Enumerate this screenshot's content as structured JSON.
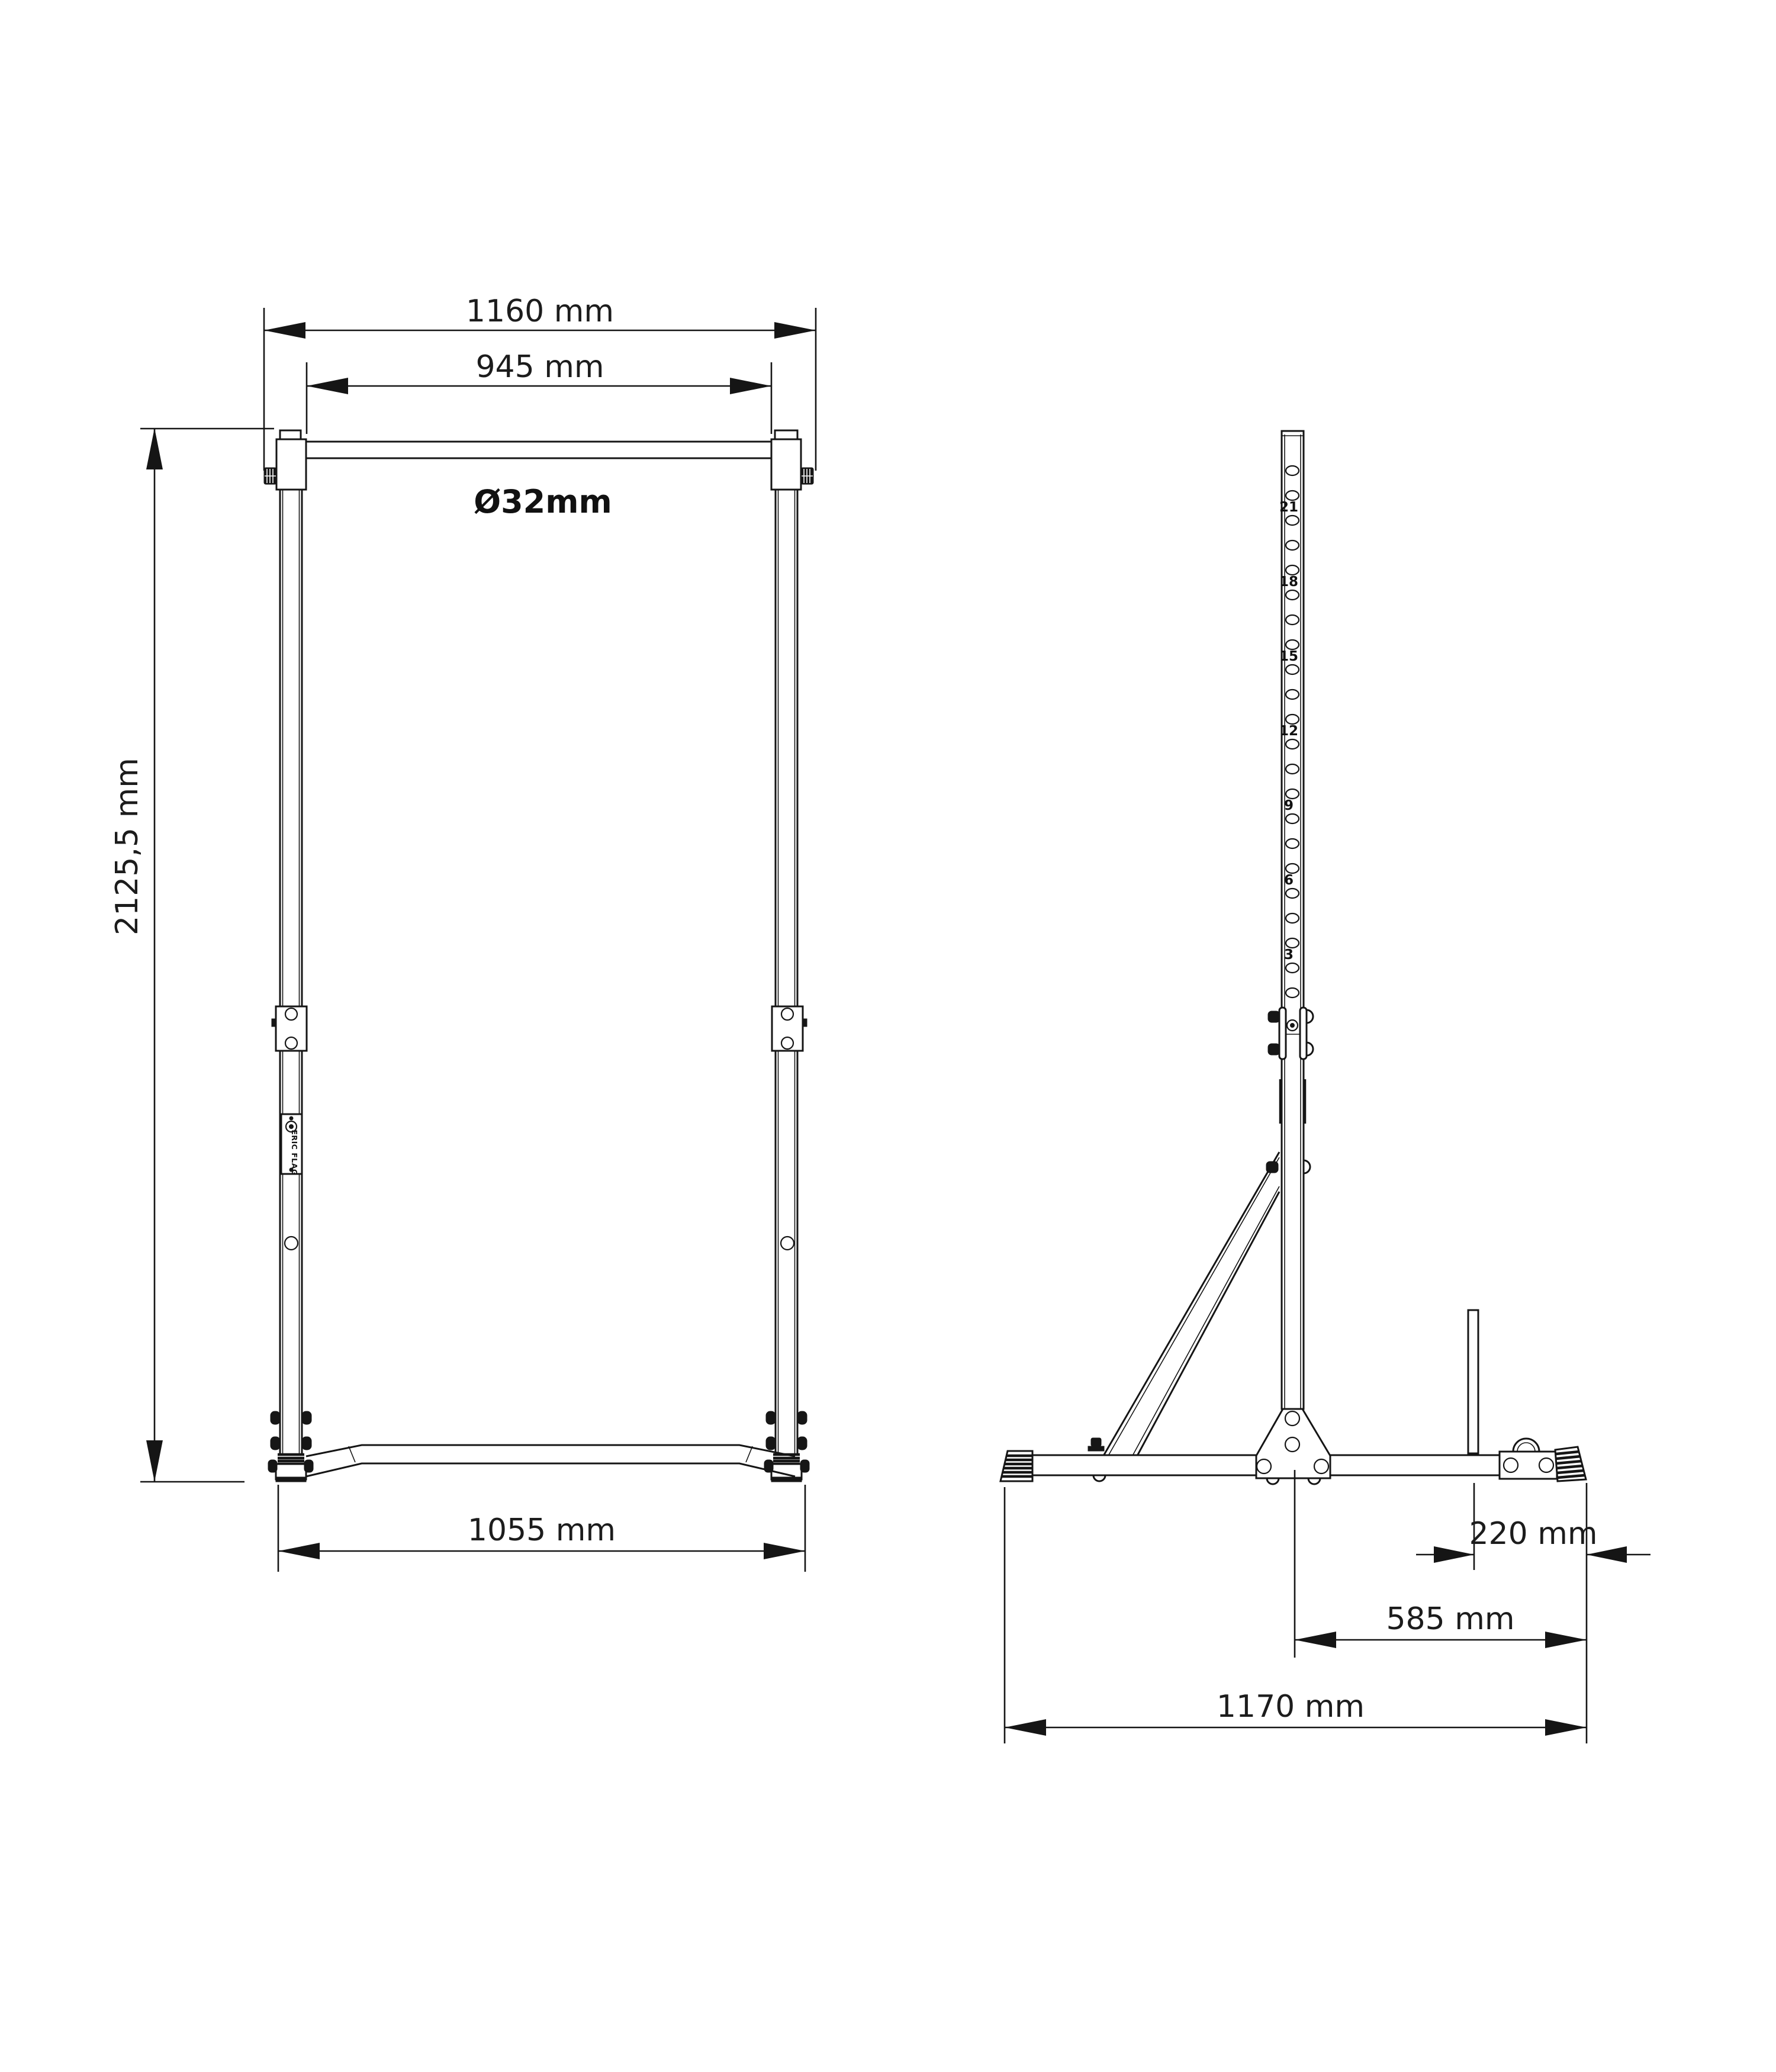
{
  "drawing": {
    "front_view": {
      "dim_top_width": "1160 mm",
      "dim_inner_width": "945 mm",
      "bar_diameter": "Ø32mm",
      "dim_height": "2125,5 mm",
      "dim_base_width": "1055 mm",
      "brand_plate_text": "ERIC FLAG"
    },
    "side_view": {
      "dim_rod_to_rear": "220 mm",
      "dim_center_to_rear": "585 mm",
      "dim_base_depth": "1170 mm",
      "hole_labels": [
        "21",
        "18",
        "15",
        "12",
        "9",
        "6",
        "3"
      ]
    },
    "colors": {
      "line": "#151515",
      "background": "#ffffff"
    }
  }
}
